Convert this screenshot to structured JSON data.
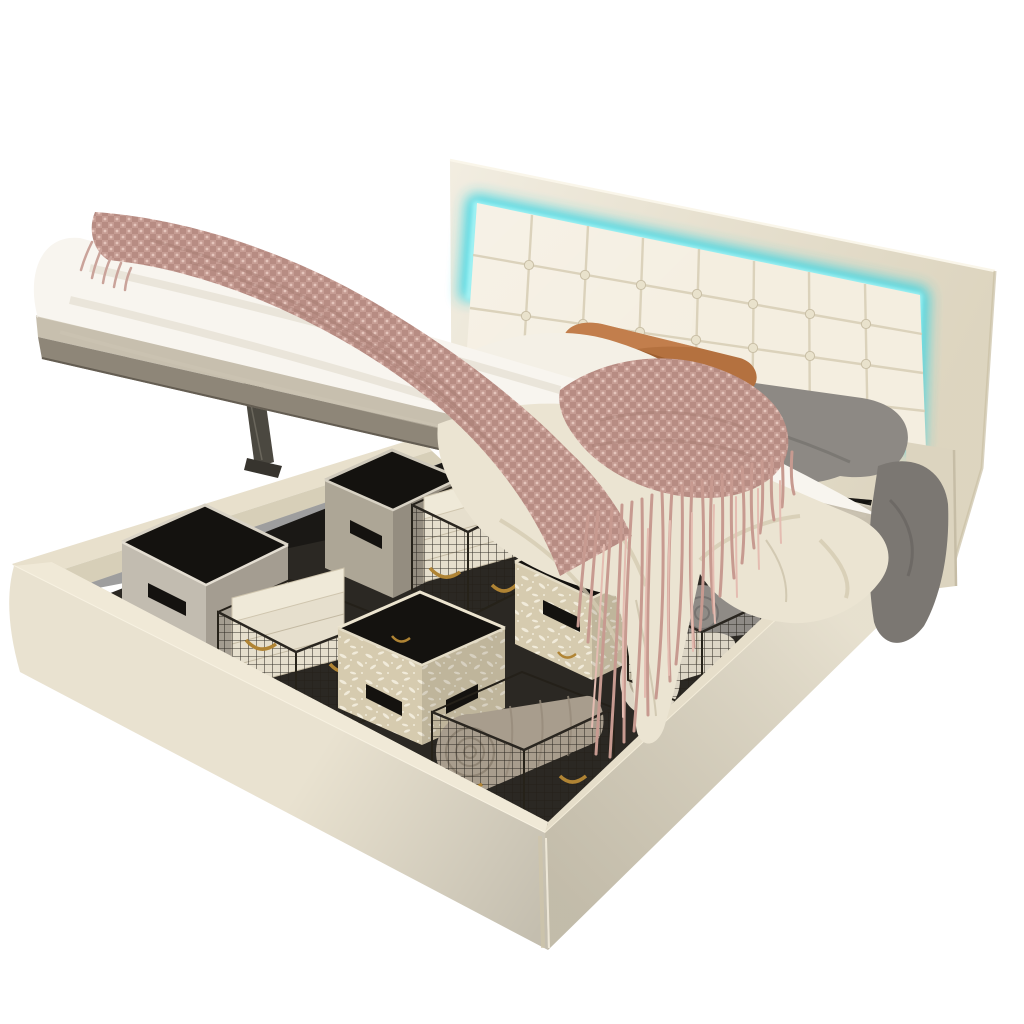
{
  "meta": {
    "kind": "product-photo",
    "background": "#ffffff"
  },
  "scene": {
    "alt": "Cream upholstered queen platform bed with button-tufted LED headboard, gas-lift hydraulic mattress platform raised open, revealing under-bed storage with fabric cubes, black wire baskets, folded linens and rolled towels",
    "objects": [
      {
        "name": "headboard",
        "desc": "button-tufted cream faux-leather headboard with glowing LED border"
      },
      {
        "name": "led-strip",
        "desc": "cyan LED light band around tufted panel"
      },
      {
        "name": "mattress",
        "desc": "white mattress lifted at an angle on hydraulic platform"
      },
      {
        "name": "platform-board",
        "desc": "gray-beige lift platform under mattress"
      },
      {
        "name": "hydraulic-strut",
        "desc": "dark gas-lift struts",
        "count": 2
      },
      {
        "name": "storage-base",
        "desc": "cream upholstered storage box with dark interior"
      },
      {
        "name": "fabric-cube-gray",
        "desc": "gray fabric storage cubes with handle cutouts",
        "count": 2
      },
      {
        "name": "fabric-cube-patterned",
        "desc": "beige leaf-print fabric storage cubes",
        "count": 2
      },
      {
        "name": "wire-basket",
        "desc": "black wire baskets with brass handles",
        "count": 4
      },
      {
        "name": "folded-linens",
        "desc": "stacks of folded cream linens",
        "count": 2
      },
      {
        "name": "rolled-towel",
        "desc": "rolled towels in taupe, gray and striped cream",
        "count": 3
      },
      {
        "name": "orange-pillow",
        "desc": "rust orange accent pillow"
      },
      {
        "name": "gray-pillow",
        "desc": "gray pillow and draped gray blanket"
      },
      {
        "name": "white-sheet",
        "desc": "white sheet fold"
      },
      {
        "name": "cream-duvet",
        "desc": "cream duvet draping into storage opening"
      },
      {
        "name": "pink-throw",
        "desc": "dusty-pink chenille throw with long fringe"
      }
    ]
  },
  "palette": {
    "bg": "#ffffff",
    "headboard_frame": "#ebe4d1",
    "headboard_frame_edge": "#d8cfb8",
    "panel_cream": "#f4eee0",
    "seam": "#d6ccb4",
    "button": "#e9e2cc",
    "led_glow": "#2fd4e4",
    "led_core": "#a5f3f4",
    "leg": "#dcd4bf",
    "back_rim": "#e8e0cc",
    "inner_wall": "#d7cfb8",
    "floor_dark": "#2b2823",
    "rim_light": "#f0e9d7",
    "rim_right": "#e6deca",
    "face_left": "#e9e2d0",
    "face_right": "#e2dac5",
    "slab_light": "#c7bfae",
    "slab_dark": "#8e8678",
    "strut": "#4b4840",
    "strut_dark": "#37342e",
    "mattress_white": "#f8f5ef",
    "sheet_white": "#f4f0e6",
    "duvet_cream": "#ebe4d2",
    "gray_blanket": "#8d8984",
    "gray_blanket_dark": "#7b7772",
    "orange_pillow": "#b4713f",
    "throw_pink": "#c69d94",
    "throw_pink_dark": "#ab7d75",
    "fringe_main": "#c79a90",
    "fringe_light": "#e4bcb1",
    "cube_gray_face": "#c2bcb0",
    "cube_gray_side": "#a49d91",
    "cube_gray2_face": "#ada696",
    "cube_gray2_side": "#948d80",
    "cube_pattern_base": "#d6cbaf",
    "cube_pattern_speckle": "#f1ebda",
    "cube_interior": "#14120f",
    "wire": "#242019",
    "gold": "#b08434",
    "linen_cream": "#e6dfcd",
    "linen_top": "#efe9d8",
    "towel_taupe": "#a89d8d",
    "towel_gray": "#8f8b86",
    "towel_white": "#ddd6c6"
  }
}
